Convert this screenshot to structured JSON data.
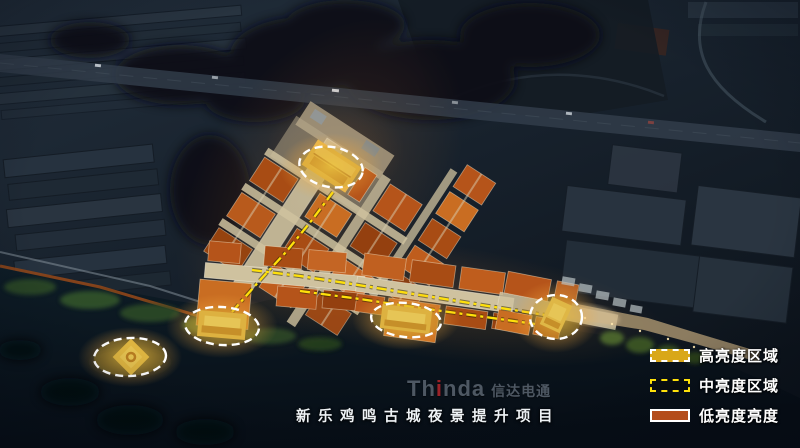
{
  "legend": {
    "items": [
      {
        "id": "high-brightness-area",
        "label": "高亮度区域",
        "swatch_color": "#d9a718",
        "swatch_border": "white-dashed"
      },
      {
        "id": "mid-brightness-area",
        "label": "中亮度区域",
        "swatch_color": "transparent",
        "swatch_border": "yellow-dashed"
      },
      {
        "id": "low-brightness-area",
        "label": "低亮度亮度",
        "swatch_color": "#b44d1b",
        "swatch_border": "white-solid"
      }
    ]
  },
  "watermark": {
    "latin_prefix": "Th",
    "latin_accent": "i",
    "latin_suffix": "nda",
    "cjk": "信达电通",
    "accent_color": "#b5262b"
  },
  "footer": {
    "caption": "新乐鸡鸣古城夜景提升项目"
  },
  "colors": {
    "high_brightness": "#d9a718",
    "mid_brightness_line": "#ffe10a",
    "low_brightness": "#b44d1b",
    "night_base": "#141d28",
    "water": "#0b1820"
  }
}
